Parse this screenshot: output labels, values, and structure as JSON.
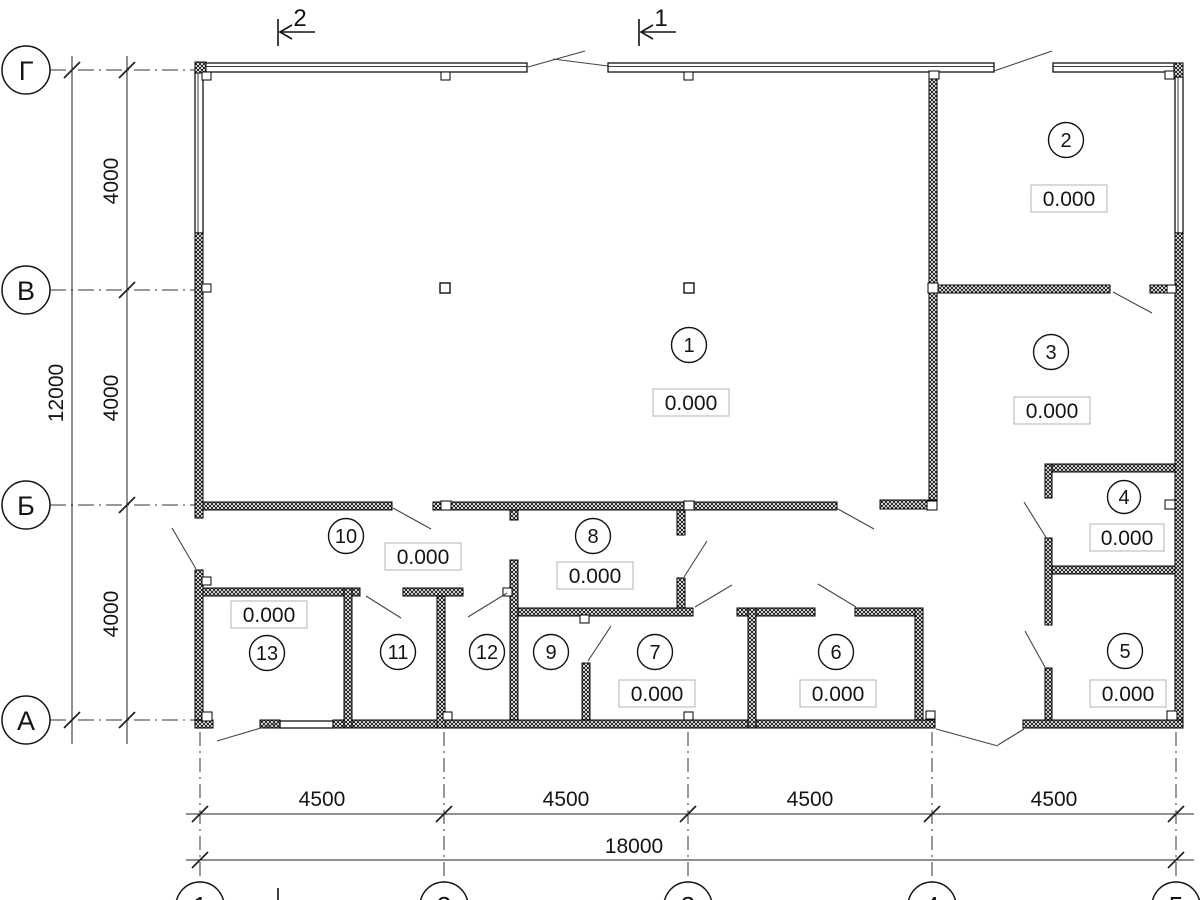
{
  "drawing": {
    "axis_letters": [
      "Г",
      "В",
      "Б",
      "А"
    ],
    "axis_numbers": [
      "1",
      "2",
      "3",
      "4",
      "5"
    ],
    "dim_vertical": {
      "segments": [
        "4000",
        "4000",
        "4000"
      ],
      "total": "12000"
    },
    "dim_horizontal": {
      "segments": [
        "4500",
        "4500",
        "4500",
        "4500"
      ],
      "total": "18000"
    },
    "section_marks": {
      "left_label": "2",
      "right_label": "1"
    },
    "rooms": [
      {
        "number": "1",
        "elevation": "0.000"
      },
      {
        "number": "2",
        "elevation": "0.000"
      },
      {
        "number": "3",
        "elevation": "0.000"
      },
      {
        "number": "4",
        "elevation": "0.000"
      },
      {
        "number": "5",
        "elevation": "0.000"
      },
      {
        "number": "6",
        "elevation": "0.000"
      },
      {
        "number": "7",
        "elevation": "0.000"
      },
      {
        "number": "8",
        "elevation": "0.000"
      },
      {
        "number": "9"
      },
      {
        "number": "10",
        "elevation": "0.000"
      },
      {
        "number": "11"
      },
      {
        "number": "12"
      },
      {
        "number": "13",
        "elevation": "0.000"
      }
    ]
  }
}
